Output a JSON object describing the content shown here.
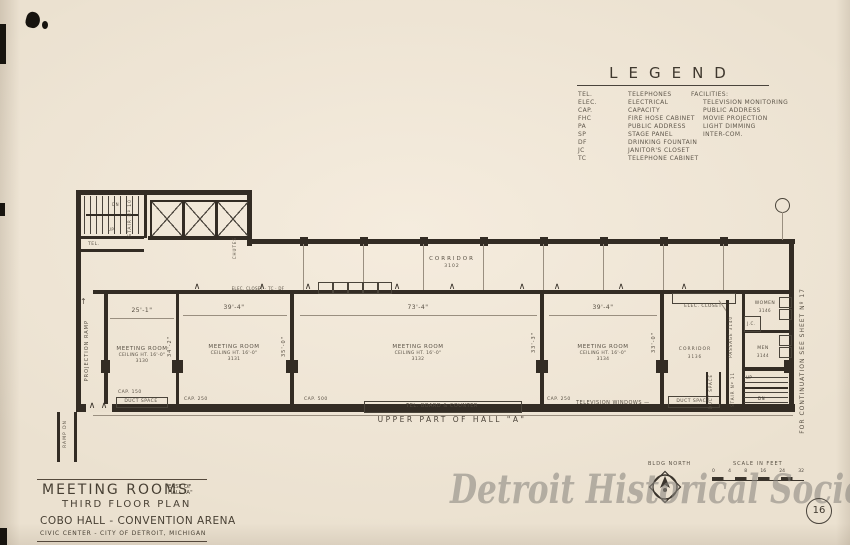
{
  "colors": {
    "paper": "#ebe1d0",
    "ink": "#4a4238",
    "wall": "#332c24",
    "watermark": "#8b8780"
  },
  "glyphs": {
    "door": "∧",
    "up_arrow": "↑"
  },
  "artifact": {
    "watermark": "Detroit Historical Society",
    "sheet_number": "16"
  },
  "legend": {
    "title": "LEGEND",
    "abbreviations": [
      {
        "abbr": "TEL.",
        "label": "TELEPHONES"
      },
      {
        "abbr": "ELEC.",
        "label": "ELECTRICAL"
      },
      {
        "abbr": "CAP.",
        "label": "CAPACITY"
      },
      {
        "abbr": "FHC",
        "label": "FIRE HOSE CABINET"
      },
      {
        "abbr": "PA",
        "label": "PUBLIC ADDRESS"
      },
      {
        "abbr": "SP",
        "label": "STAGE PANEL"
      },
      {
        "abbr": "DF",
        "label": "DRINKING FOUNTAIN"
      },
      {
        "abbr": "JC",
        "label": "JANITOR'S CLOSET"
      },
      {
        "abbr": "TC",
        "label": "TELEPHONE CABINET"
      }
    ],
    "facilities_title": "FACILITIES:",
    "facilities": [
      "TELEVISION MONITORING",
      "PUBLIC ADDRESS",
      "MOVIE PROJECTION",
      "LIGHT DIMMING",
      "INTER-COM."
    ]
  },
  "plan": {
    "continuation_note": "FOR CONTINUATION SEE SHEET Nº 17",
    "upper_hall_label": "UPPER PART OF HALL \"A\"",
    "corridor": {
      "label": "CORRIDOR",
      "number": "3102"
    },
    "rooms": [
      {
        "name": "MEETING ROOM",
        "ceiling": "CEILING HT. 16'-0\"",
        "number": "3130",
        "width": "25'-1\"",
        "cap": "CAP. 150",
        "side": "34'-2\""
      },
      {
        "name": "MEETING ROOM",
        "ceiling": "CEILING HT. 16'-0\"",
        "number": "3131",
        "width": "39'-4\"",
        "cap": "CAP. 250",
        "side": "35'-0\""
      },
      {
        "name": "MEETING ROOM",
        "ceiling": "CEILING HT. 16'-0\"",
        "number": "3132",
        "width": "73'-4\"",
        "cap": "CAP. 500",
        "side": "33'-3\""
      },
      {
        "name": "MEETING ROOM",
        "ceiling": "CEILING HT. 16'-0\"",
        "number": "3134",
        "width": "39'-4\"",
        "cap": "CAP. 250",
        "side": "33'-0\""
      }
    ],
    "annotations": {
      "stair10": "STAIR Nº 10",
      "stair11": "STAIR Nº 11",
      "chutes": "CHUTES",
      "tel_room": "TEL.",
      "projection_ramp": "PROJECTION RAMP",
      "ramp_dn": "RAMP DN",
      "up": "UP",
      "dn": "DN",
      "duct_space_left": "DUCT SPACE",
      "duct_space_right": "DUCT SPACE",
      "duct_space_vertical": "DUCT SPACE",
      "tel_board": "TEL. BOARD & COUNTER",
      "television_windows": "TELEVISION WINDOWS —",
      "closet_row": "ELEC. CLOSET · TC · DF",
      "elec_closet": "ELEC. CLOSET",
      "corridor_right": {
        "label": "CORRIDOR",
        "number": "3136"
      },
      "passage": {
        "label": "PASSAGE  3140"
      },
      "women": {
        "label": "WOMEN",
        "number": "3146"
      },
      "men": {
        "label": "MEN",
        "number": "3144"
      },
      "jc": "J.C."
    }
  },
  "titleblock": {
    "title": "MEETING ROOMS",
    "suffix_line1": "EAST OF",
    "suffix_line2": "HALL \"A\"",
    "subtitle": "THIRD FLOOR PLAN",
    "building": "COBO HALL - CONVENTION ARENA",
    "location": "CIVIC CENTER - CITY OF DETROIT, MICHIGAN"
  },
  "footer": {
    "north_label": "BLDG NORTH",
    "scale_label": "SCALE IN FEET",
    "scale_ticks": [
      "0",
      "4",
      "8",
      "16",
      "24",
      "32"
    ]
  }
}
